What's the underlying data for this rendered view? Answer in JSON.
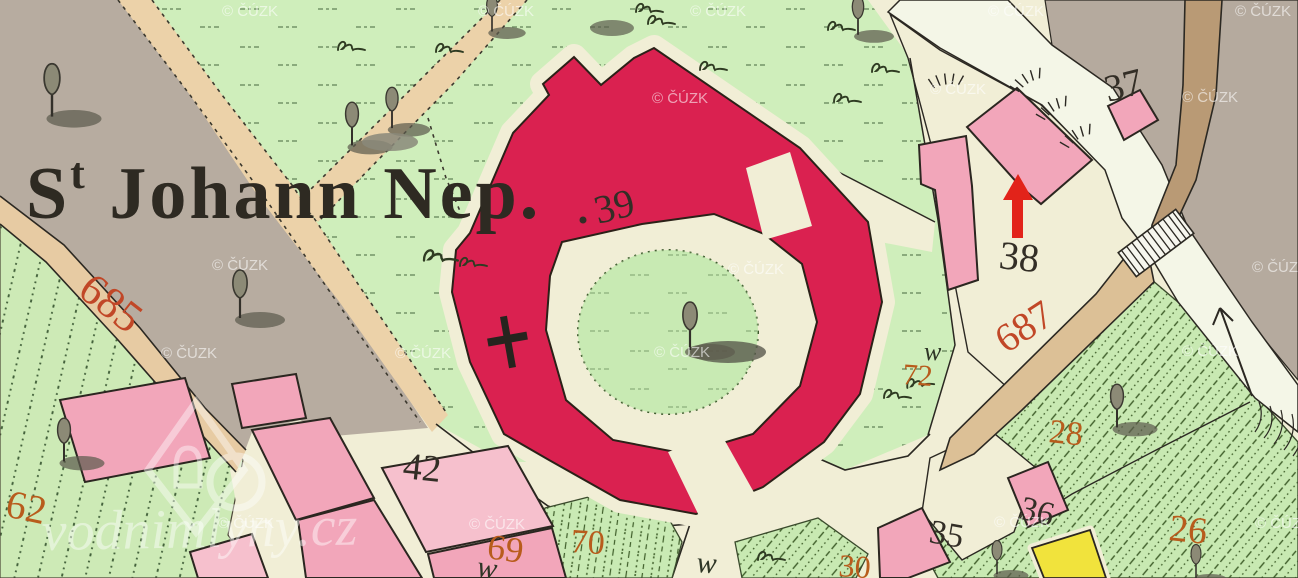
{
  "map": {
    "place_label": {
      "prefix": "S",
      "superscript": "t",
      "rest": " Johann Nep."
    },
    "parcel_numbers": {
      "p26": "26",
      "p28": "28",
      "p30": "30",
      "p35": "35",
      "p36": "36",
      "p37": "37",
      "p38": "38",
      "p39": "39",
      "p42": "42",
      "p62": "62",
      "p69": "69",
      "p70": "70",
      "p72": "72"
    },
    "road_numbers": {
      "r685": "685",
      "r687": "687"
    },
    "letter_marks": {
      "w1": "w",
      "w2": "w",
      "w3": "w"
    },
    "colors": {
      "paper_cream": "#f1eed6",
      "meadow_green": "#cfeebb",
      "garden_green": "#c8e9b2",
      "hatch_green": "#3f5e2a",
      "gray_area": "#b7aca0",
      "building_red": "#da2150",
      "building_pink": "#f2a6ba",
      "building_pink_light": "#f6c0cd",
      "building_yellow": "#f1e33c",
      "road_tan": "#e7cba3",
      "road_brown": "#b99a75",
      "stream_white": "#f4f6e7",
      "number_orange": "#b85c1c",
      "number_red": "#c14727",
      "highlight_arrow_red": "#e2231a",
      "ink_black": "#2b2822"
    },
    "icons": [
      "tree-icon",
      "grass-tuft-icon",
      "cross-icon",
      "bridge-icon",
      "flow-arrow-icon",
      "highlight-arrow-icon",
      "roof-hatch-icon",
      "bank-hatch-icon"
    ]
  },
  "watermarks": {
    "text": "© ČÚZK",
    "positions": [
      [
        222,
        16
      ],
      [
        478,
        16
      ],
      [
        690,
        16
      ],
      [
        988,
        16
      ],
      [
        1235,
        16
      ],
      [
        652,
        103
      ],
      [
        930,
        94
      ],
      [
        1182,
        102
      ],
      [
        212,
        270
      ],
      [
        728,
        274
      ],
      [
        1252,
        272
      ],
      [
        161,
        358
      ],
      [
        395,
        358
      ],
      [
        654,
        357
      ],
      [
        1182,
        356
      ],
      [
        218,
        528
      ],
      [
        469,
        529
      ],
      [
        994,
        527
      ],
      [
        1255,
        528
      ]
    ]
  },
  "site_watermark": {
    "text": "vodnimlyny.cz"
  }
}
